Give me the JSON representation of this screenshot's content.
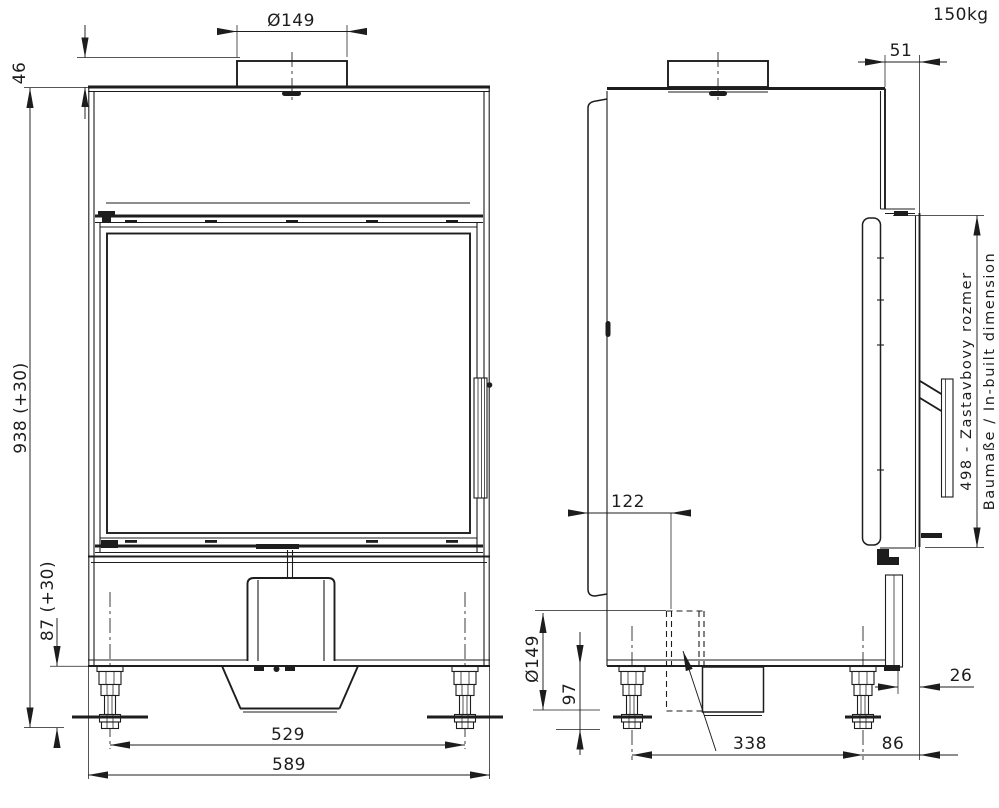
{
  "drawing": {
    "weight_note": "150kg",
    "colors": {
      "line": "#1d1d1d",
      "background": "#ffffff"
    },
    "front_view": {
      "flue_diameter": "Ø149",
      "collar_height": "46",
      "overall_height": "938 (+30)",
      "plinth_height": "87 (+30)",
      "feet_spacing": "529",
      "overall_width": "589"
    },
    "side_view": {
      "frame_projection": "51",
      "inbuilt_note_sk": "498 - Zastavbovy rozmer",
      "inbuilt_note_de_en": "Baumaße / In-built dimension",
      "intake_offset_from_back": "122",
      "intake_diameter": "Ø149",
      "leg_height": "97",
      "feet_spacing": "338",
      "foot_to_front": "86",
      "panel_gap": "26"
    }
  }
}
